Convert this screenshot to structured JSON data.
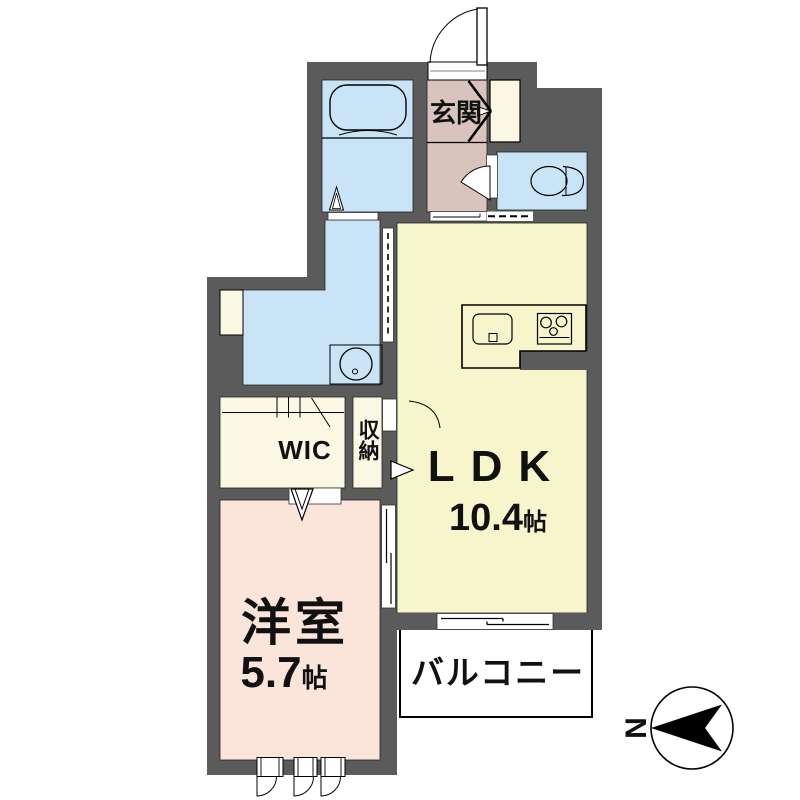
{
  "floor_plan": {
    "rooms": {
      "entrance": {
        "label": "玄関"
      },
      "ldk": {
        "label": "LDK",
        "size_value": "10.4",
        "size_unit": "帖"
      },
      "western_room": {
        "label": "洋室",
        "size_value": "5.7",
        "size_unit": "帖"
      },
      "wic": {
        "label": "WIC"
      },
      "storage": {
        "label": "収納"
      },
      "balcony": {
        "label": "バルコニー"
      }
    },
    "compass": {
      "north_label": "N"
    },
    "colors": {
      "wall": "#5b5b5b",
      "water_room": "#c9e4f7",
      "entrance": "#d9c3bd",
      "ldk": "#f7f5cb",
      "storage": "#faf7e3",
      "bedroom": "#fbe4d9",
      "balcony": "#ffffff",
      "line": "#000000"
    }
  }
}
